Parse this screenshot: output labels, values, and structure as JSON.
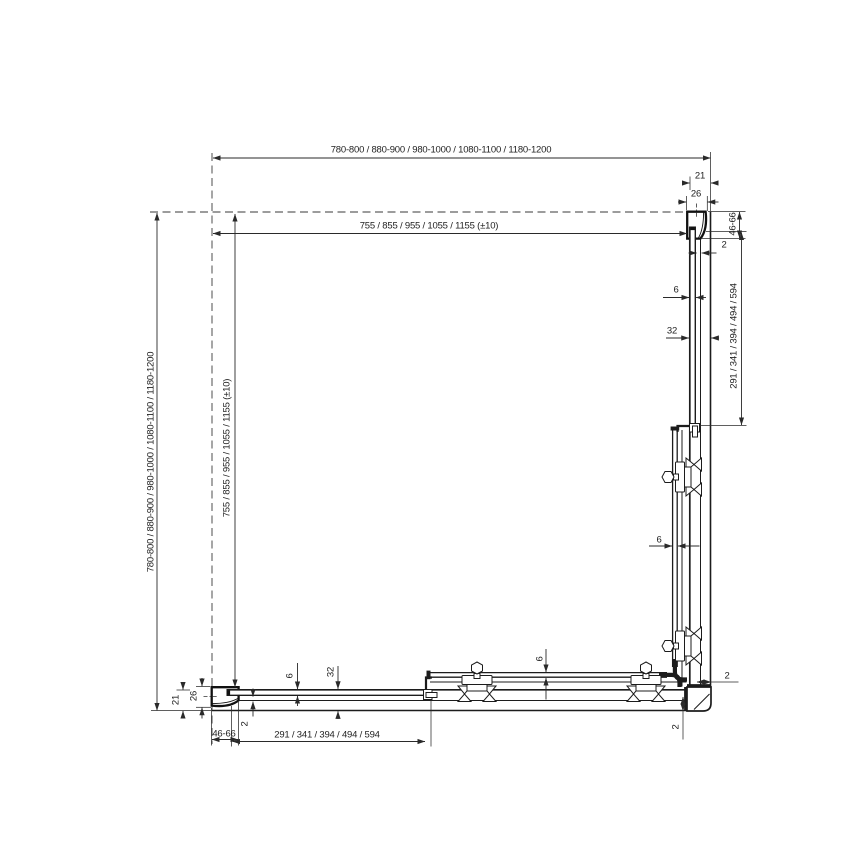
{
  "drawing": {
    "kind": "corner shower enclosure plan view technical drawing",
    "colors": {
      "structure_line": "#1c1c1c",
      "dimension_line": "#2a2a2a",
      "background": "#ffffff"
    }
  },
  "labels": {
    "overall_width": "780-800 / 880-900 / 980-1000 / 1080-1100 / 1180-1200",
    "glass_width": "755 / 855 / 955 / 1055 / 1155 (±10)",
    "overall_depth": "780-800 / 880-900 / 980-1000 / 1080-1100 / 1180-1200",
    "glass_depth": "755 / 855 / 955 / 1055 / 1155 (±10)",
    "top_21": "21",
    "top_26": "26",
    "top_46_66": "46-66",
    "top_2": "2",
    "right_6": "6",
    "right_32": "32",
    "right_segments": "291 / 341 / 394 / 494 / 594",
    "right_door_6": "6",
    "corner_2_h": "2",
    "corner_2_v": "2",
    "left_21": "21",
    "left_26": "26",
    "left_46_66": "46-66",
    "left_2": "2",
    "bottom_6": "6",
    "bottom_32": "32",
    "bottom_segments": "291 / 341 / 394 / 494 / 594",
    "bottom_door_6": "6"
  }
}
